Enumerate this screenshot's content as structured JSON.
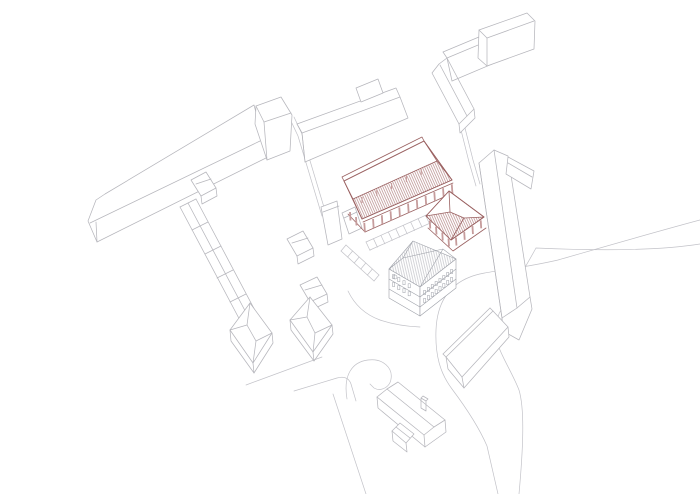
{
  "page": {
    "title": "Site axonometric drawing",
    "width": 700,
    "height": 494,
    "background": "#ffffff"
  },
  "drawing": {
    "type": "axonometric-site-plan",
    "style": "wireframe-line-drawing",
    "highlight_meaning": "proposed-structures-highlighted-in-red-hatch",
    "colors": {
      "background": "#ffffff",
      "context_line": "#b6b6bc",
      "detail_line": "#9da0a8",
      "road_line": "#c2c2c8",
      "highlight_line": "#9a6161",
      "highlight_hatch": "#b78b8b",
      "highlight_fill": "#c69c9c"
    },
    "elements": [
      {
        "name": "long-bar-building-northwest",
        "role": "context"
      },
      {
        "name": "bar-end-block",
        "role": "context"
      },
      {
        "name": "mid-bar-building",
        "role": "context"
      },
      {
        "name": "l-shaped-building-north",
        "role": "context"
      },
      {
        "name": "north-bar-wing",
        "role": "context"
      },
      {
        "name": "tower-block-north",
        "role": "context"
      },
      {
        "name": "long-gabled-building-east",
        "role": "context"
      },
      {
        "name": "east-wing-annex",
        "role": "context"
      },
      {
        "name": "small-house-north",
        "role": "context"
      },
      {
        "name": "terraced-row-west",
        "role": "context"
      },
      {
        "name": "row-houses-east",
        "role": "context"
      },
      {
        "name": "narrow-tower-house",
        "role": "context"
      },
      {
        "name": "corner-house-south-a",
        "role": "context"
      },
      {
        "name": "corner-house-south-b",
        "role": "context"
      },
      {
        "name": "existing-main-building",
        "role": "context-detailed"
      },
      {
        "name": "warehouse-building-south",
        "role": "context"
      },
      {
        "name": "detached-house-south",
        "role": "context"
      },
      {
        "name": "house-annex-south",
        "role": "context"
      },
      {
        "name": "ramp-structure",
        "role": "context"
      },
      {
        "name": "road-network",
        "role": "context"
      },
      {
        "name": "parking-stalls",
        "role": "context"
      },
      {
        "name": "market-hall-canopy",
        "role": "highlighted"
      },
      {
        "name": "garden-pavilion",
        "role": "highlighted"
      }
    ]
  },
  "details": {
    "market_hall_columns_front": 11,
    "market_hall_columns_back": 5,
    "pavilion_columns_per_edge": 4,
    "parking_stalls_south": 9,
    "parking_stalls_west": 6,
    "existing_building_windows": {
      "se_rows": 2,
      "se_cols": 8,
      "sw_rows": 2,
      "sw_cols": 4
    }
  }
}
